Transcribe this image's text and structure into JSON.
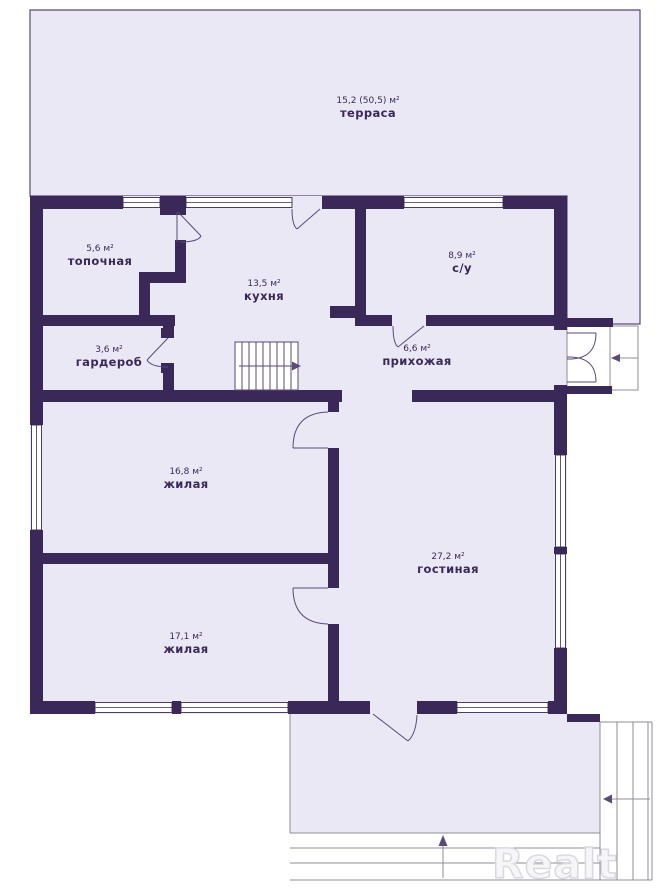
{
  "watermark": "Realt",
  "colors": {
    "wall": "#3a2958",
    "fill": "#eae8f5",
    "line": "#5a4a78",
    "gray": "#8e8c99",
    "text": "#3a2958",
    "wm": "#d9d9e2"
  },
  "rooms": [
    {
      "id": "terrace",
      "name": "терраса",
      "area": "15,2 (50,5) м²"
    },
    {
      "id": "boiler-room",
      "name": "топочная",
      "area": "5,6 м²"
    },
    {
      "id": "kitchen",
      "name": "кухня",
      "area": "13,5 м²"
    },
    {
      "id": "bathroom",
      "name": "с/у",
      "area": "8,9 м²"
    },
    {
      "id": "wardrobe",
      "name": "гардероб",
      "area": "3,6 м²"
    },
    {
      "id": "hallway",
      "name": "прихожая",
      "area": "6,6 м²"
    },
    {
      "id": "living-room-1",
      "name": "жилая",
      "area": "16,8 м²"
    },
    {
      "id": "lounge",
      "name": "гостиная",
      "area": "27,2 м²"
    },
    {
      "id": "living-room-2",
      "name": "жилая",
      "area": "17,1 м²"
    }
  ]
}
